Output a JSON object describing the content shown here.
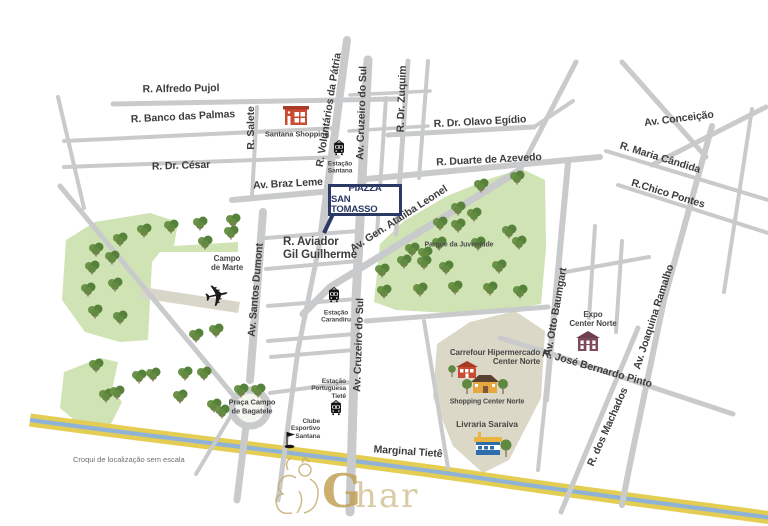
{
  "note": "Croqui de localização sem escala",
  "watermark": {
    "g": "G",
    "rest": "har"
  },
  "callout": {
    "line1": "PIAZZA",
    "line2": "SAN TOMASSO"
  },
  "colors": {
    "navy": "#2b3a64",
    "road": "#c9cacb",
    "park_green": "#cfe3b4",
    "tree_green": "#5d8a40",
    "river_yellow": "#e3cd52",
    "river_blue": "#8fb3d8",
    "area_beige": "#dbd8c7",
    "building_red": "#c84b32",
    "building_orange": "#e6a83e",
    "building_blue": "#2e6cab",
    "building_maroon": "#7d4a5d",
    "watermark_gold": "#c2a257"
  },
  "streets": {
    "alfredo_pujol": "R. Alfredo Pujol",
    "banco_das_palmas": "R. Banco das Palmas",
    "dr_cesar": "R. Dr. César",
    "salete": "R. Salete",
    "voluntarios_da_patria": "R. Voluntários da Pátria",
    "cruzeiro_do_sul_top": "Av. Cruzeiro do Sul",
    "dr_zuquim": "R. Dr. Zuquim",
    "olavo_egidio": "R. Dr. Olavo Egídio",
    "duarte_de_azevedo": "R. Duarte de Azevedo",
    "conceicao": "Av. Conceição",
    "maria_candida": "R. Maria Cândida",
    "chico_pontes": "R.Chico Pontes",
    "braz_leme": "Av. Braz Leme",
    "ataliba_leonel": "Av. Gen. Ataliba Leonel",
    "aviador_gil_guilherme": [
      "R. Aviador",
      "Gil Guilherme"
    ],
    "santos_dumont": "Av. Santos Dumont",
    "cruzeiro_do_sul_bottom": "Av. Cruzeiro do Sul",
    "otto_baumgart": "Av. Otto Baumgart",
    "joaquina_ramalho": "Av. Joaquina Ramalho",
    "jose_bernardo_pinto": "R. José Bernardo Pinto",
    "dos_machados": "R. dos Machados",
    "marginal_tiete": "Marginal Tietê"
  },
  "places": {
    "santana_shopping": "Santana Shopping",
    "estacao_santana": [
      "Estação",
      "Santana"
    ],
    "campo_de_marte": [
      "Campo",
      "de Marte"
    ],
    "parque_da_juventude": "Parque da Juventude",
    "estacao_carandiru": [
      "Estação",
      "Carandiru"
    ],
    "expo_center_norte": [
      "Expo",
      "Center Norte"
    ],
    "carrefour": [
      "Carrefour Hipermercado",
      "Center Norte"
    ],
    "shopping_center_norte": "Shopping Center Norte",
    "livraria_saraiva": "Livraria Saraiva",
    "praca_campo_de_bagatele": [
      "Praça Campo",
      "de Bagatele"
    ],
    "estacao_portuguesa_tiete": [
      "Estação",
      "Portuguesa",
      "Tietê"
    ],
    "clube_esportivo_santana": [
      "Clube",
      "Esportivo",
      "Santana"
    ]
  }
}
